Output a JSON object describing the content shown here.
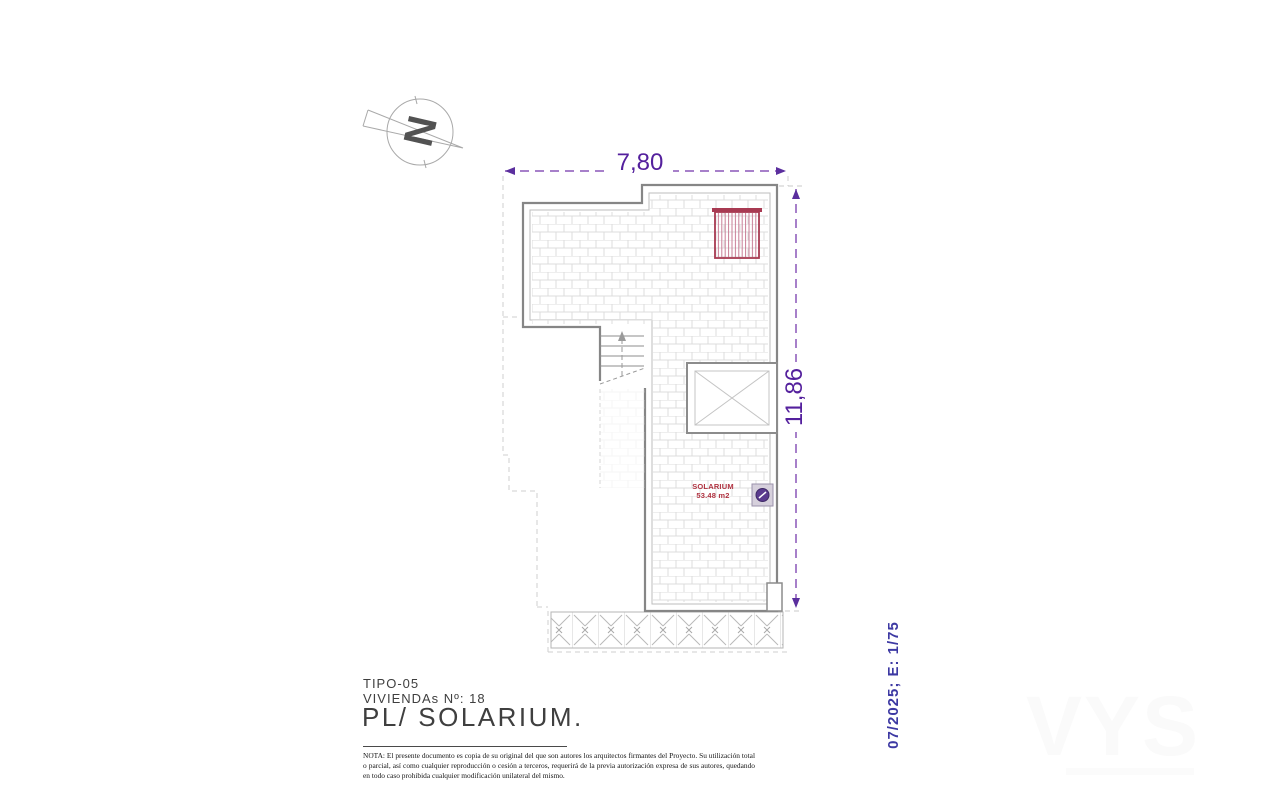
{
  "document": {
    "type_code": "TIPO-05",
    "dwellings": "VIVIENDAs Nº: 18",
    "plan_title": "PL/ SOLARIUM."
  },
  "plan": {
    "north_letter": "N",
    "dim_width": "7,80",
    "dim_height": "11,86",
    "room_name": "SOLARIUM",
    "room_area": "53.48 m2"
  },
  "stamp": {
    "date_scale": "07/2025; E: 1/75"
  },
  "note": "NOTA: El presente documento es copia de su original del que son autores los arquitectos firmantes del Proyecto. Su utilización total o parcial, así como cualquier reproducción o cesión a terceros, requerirá  de la previa autorización expresa de sus autores, quedando en todo caso prohibida cualquier modificación unilateral del mismo.",
  "watermark": "VYS",
  "colors": {
    "dimension_text": "#54209d",
    "dimension_line": "#8a56b8",
    "stamp_text": "#3d39a3",
    "room_label": "#b03240",
    "pergola": "#a83a52",
    "outline": "#868686",
    "hatch": "#dcdcdc"
  }
}
